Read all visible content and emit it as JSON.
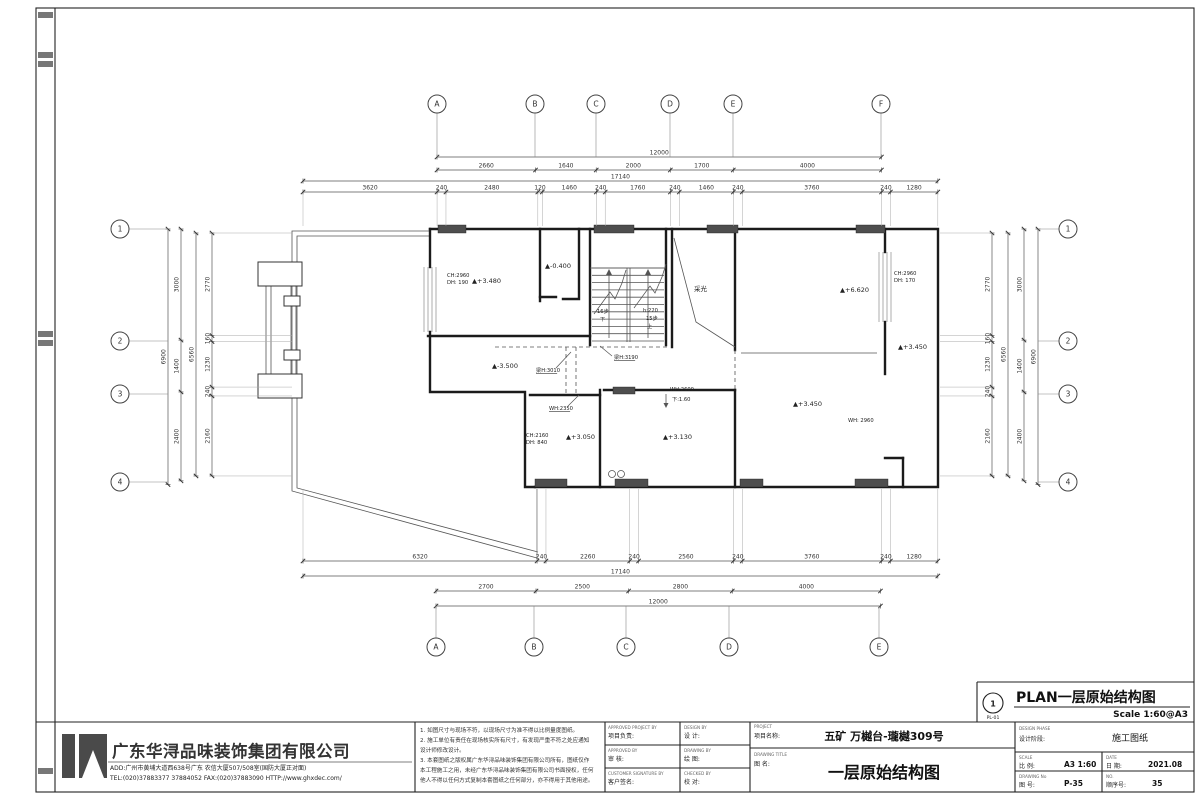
{
  "plan_ref": {
    "num": "1",
    "code": "PL-01",
    "title": "PLAN一层原始结构图",
    "scale": "Scale 1:60@A3"
  },
  "plan": {
    "scale_per_px": 27,
    "grid": {
      "top": {
        "y": 104,
        "stem": [
          113,
          157
        ],
        "items": [
          {
            "l": "A",
            "x": 437
          },
          {
            "l": "B",
            "x": 535
          },
          {
            "l": "C",
            "x": 596
          },
          {
            "l": "D",
            "x": 670
          },
          {
            "l": "E",
            "x": 733
          },
          {
            "l": "F",
            "x": 881
          }
        ]
      },
      "bottom": {
        "y": 647,
        "stem": [
          606,
          638
        ],
        "items": [
          {
            "l": "A",
            "x": 436
          },
          {
            "l": "B",
            "x": 534
          },
          {
            "l": "C",
            "x": 626
          },
          {
            "l": "D",
            "x": 729
          },
          {
            "l": "E",
            "x": 879
          }
        ]
      },
      "left": {
        "x": 120,
        "stem": [
          129,
          168
        ],
        "items": [
          {
            "l": "1",
            "y": 229
          },
          {
            "l": "2",
            "y": 341
          },
          {
            "l": "3",
            "y": 394
          },
          {
            "l": "4",
            "y": 482
          }
        ]
      },
      "right": {
        "x": 1068,
        "stem": [
          1038,
          1059
        ],
        "items": [
          {
            "l": "1",
            "y": 229
          },
          {
            "l": "2",
            "y": 341
          },
          {
            "l": "3",
            "y": 394
          },
          {
            "l": "4",
            "y": 482
          }
        ]
      }
    },
    "dim_rows": [
      {
        "dir": "h",
        "pos": 157,
        "origin": 437,
        "values": [
          12000
        ]
      },
      {
        "dir": "h",
        "pos": 170,
        "origin": 437,
        "values": [
          2660,
          1640,
          2000,
          1700,
          4000
        ]
      },
      {
        "dir": "h",
        "pos": 181,
        "origin": 303,
        "values": [
          17140
        ]
      },
      {
        "dir": "h",
        "pos": 192,
        "origin": 303,
        "values": [
          3620,
          240,
          2480,
          120,
          1460,
          240,
          1760,
          240,
          1460,
          240,
          3760,
          240,
          1280
        ],
        "ext": [
          194,
          226
        ]
      },
      {
        "dir": "h",
        "pos": 561,
        "origin": 303,
        "values": [
          6320,
          240,
          2260,
          240,
          2560,
          240,
          3760,
          240,
          1280
        ],
        "ext": [
          489,
          559
        ]
      },
      {
        "dir": "h",
        "pos": 576,
        "origin": 303,
        "values": [
          17140
        ]
      },
      {
        "dir": "h",
        "pos": 591,
        "origin": 436,
        "values": [
          2700,
          2500,
          2800,
          4000
        ]
      },
      {
        "dir": "h",
        "pos": 606,
        "origin": 436,
        "values": [
          12000
        ]
      },
      {
        "dir": "v",
        "pos": 168,
        "origin": 229,
        "values": [
          6900
        ]
      },
      {
        "dir": "v",
        "pos": 181,
        "origin": 229,
        "values": [
          3000,
          1400,
          2400
        ]
      },
      {
        "dir": "v",
        "pos": 196,
        "origin": 233,
        "values": [
          6560
        ]
      },
      {
        "dir": "v",
        "pos": 212,
        "origin": 233,
        "values": [
          2770,
          160,
          1230,
          240,
          2160
        ],
        "ext": [
          214,
          292
        ]
      },
      {
        "dir": "v",
        "pos": 992,
        "origin": 233,
        "values": [
          2770,
          160,
          1230,
          240,
          2160
        ],
        "ext": [
          940,
          990
        ]
      },
      {
        "dir": "v",
        "pos": 1008,
        "origin": 233,
        "values": [
          6560
        ]
      },
      {
        "dir": "v",
        "pos": 1024,
        "origin": 229,
        "values": [
          3000,
          1400,
          2400
        ]
      },
      {
        "dir": "v",
        "pos": 1038,
        "origin": 229,
        "values": [
          6900
        ]
      }
    ],
    "annotations": [
      {
        "t": "CH:2960",
        "x": 447,
        "y": 277,
        "s": 5.2
      },
      {
        "t": "DH: 190",
        "x": 447,
        "y": 284,
        "s": 5.2
      },
      {
        "t": "▲+3.480",
        "x": 472,
        "y": 283,
        "s": 6.5
      },
      {
        "t": "▲-0.400",
        "x": 545,
        "y": 268,
        "s": 6.5
      },
      {
        "t": "16步",
        "x": 597,
        "y": 313,
        "s": 5.2
      },
      {
        "t": "下",
        "x": 600,
        "y": 321,
        "s": 5.2
      },
      {
        "t": "h:220",
        "x": 643,
        "y": 312,
        "s": 5.2
      },
      {
        "t": "15步",
        "x": 646,
        "y": 320,
        "s": 5.2
      },
      {
        "t": "上",
        "x": 647,
        "y": 328,
        "s": 5.2
      },
      {
        "t": "采光",
        "x": 694,
        "y": 291,
        "s": 6.5
      },
      {
        "t": "▲+6.620",
        "x": 840,
        "y": 292,
        "s": 6.5
      },
      {
        "t": "CH:2960",
        "x": 894,
        "y": 275,
        "s": 5.2
      },
      {
        "t": "DH: 170",
        "x": 894,
        "y": 282,
        "s": 5.2
      },
      {
        "t": "梁H:3190",
        "x": 614,
        "y": 359,
        "s": 5.2,
        "ul": true,
        "leader": [
          612,
          356,
          600,
          346
        ]
      },
      {
        "t": "▲-3.500",
        "x": 492,
        "y": 368,
        "s": 6.5
      },
      {
        "t": "梁H:3010",
        "x": 536,
        "y": 372,
        "s": 5.2,
        "ul": true,
        "leader": [
          556,
          368,
          571,
          352
        ]
      },
      {
        "t": "WH:2350",
        "x": 549,
        "y": 410,
        "s": 5.2,
        "ul": true,
        "leader": [
          568,
          406,
          579,
          395
        ]
      },
      {
        "t": "CH:2160",
        "x": 526,
        "y": 437,
        "s": 5.2
      },
      {
        "t": "DH: 840",
        "x": 526,
        "y": 444,
        "s": 5.2
      },
      {
        "t": "▲+3.050",
        "x": 566,
        "y": 439,
        "s": 6.5
      },
      {
        "t": "WH:2600",
        "x": 670,
        "y": 391,
        "s": 5.2
      },
      {
        "t": "下:1.60",
        "x": 672,
        "y": 401,
        "s": 5.2
      },
      {
        "t": "▲+3.130",
        "x": 663,
        "y": 439,
        "s": 6.5
      },
      {
        "t": "▲+3.450",
        "x": 793,
        "y": 406,
        "s": 6.5
      },
      {
        "t": "WH: 2960",
        "x": 848,
        "y": 422,
        "s": 5.2
      },
      {
        "t": "▲+3.450",
        "x": 898,
        "y": 349,
        "s": 6.5
      }
    ]
  },
  "title_block": {
    "company": {
      "name": "广东华浔品味装饰集团有限公司",
      "address": "ADD:广州市黄埔大道西638号广东 农信大厦507/508室(国防大厦正对面)",
      "contact": "TEL:(020)37883377   37884052      FAX:(020)37883090      HTTP://www.ghxdec.com/"
    },
    "notes_lines": [
      "1. 如图尺寸与现场不符，以现场尺寸为准不得以比例量度图纸。",
      "2. 施工单位有责任在现场核实所有尺寸，有发现严重不符之处应通知",
      "    设计师修改设计。",
      "3. 本套图纸之版权属广东华浔品味装饰集团有限公司所有，图纸仅作",
      "    本工程施工之用，未经广东华浔品味装饰集团有限公司书面授权，任何",
      "    他人不得以任何方式复制本套图纸之任何部分，亦不得用于其他用途。"
    ],
    "approvals": {
      "col1": [
        {
          "en": "APPROVED PROJECT BY",
          "zh": "项目负责:"
        },
        {
          "en": "APPROVED BY",
          "zh": "审 核:"
        },
        {
          "en": "CUSTOMER SIGNATURE BY",
          "zh": "客户签名:"
        }
      ],
      "col2": [
        {
          "en": "DESIGN BY",
          "zh": "设 计:"
        },
        {
          "en": "DRAWING BY",
          "zh": "绘 图:"
        },
        {
          "en": "CHECKED BY",
          "zh": "校 对:"
        }
      ]
    },
    "project": {
      "en": "PROJECT",
      "zh": "项目名称:",
      "value": "五矿 万樾台-瓏樾309号"
    },
    "drawing_title": {
      "en": "DRAWING TITLE",
      "zh": "图 名:",
      "value": "一层原始结构图"
    },
    "design_phase": {
      "en": "DESIGN PHASE",
      "zh": "设计阶段:",
      "value": "施工图纸"
    },
    "scale": {
      "en": "SCALE",
      "zh": "比 例:",
      "value": "A3 1:60"
    },
    "date": {
      "en": "DATE",
      "zh": "日 期:",
      "value": "2021.08"
    },
    "drawing_no": {
      "en": "DRAWING No",
      "zh": "图 号:",
      "value": "P-35"
    },
    "no": {
      "en": "NO.",
      "zh": "顺序号:",
      "value": "35"
    }
  }
}
